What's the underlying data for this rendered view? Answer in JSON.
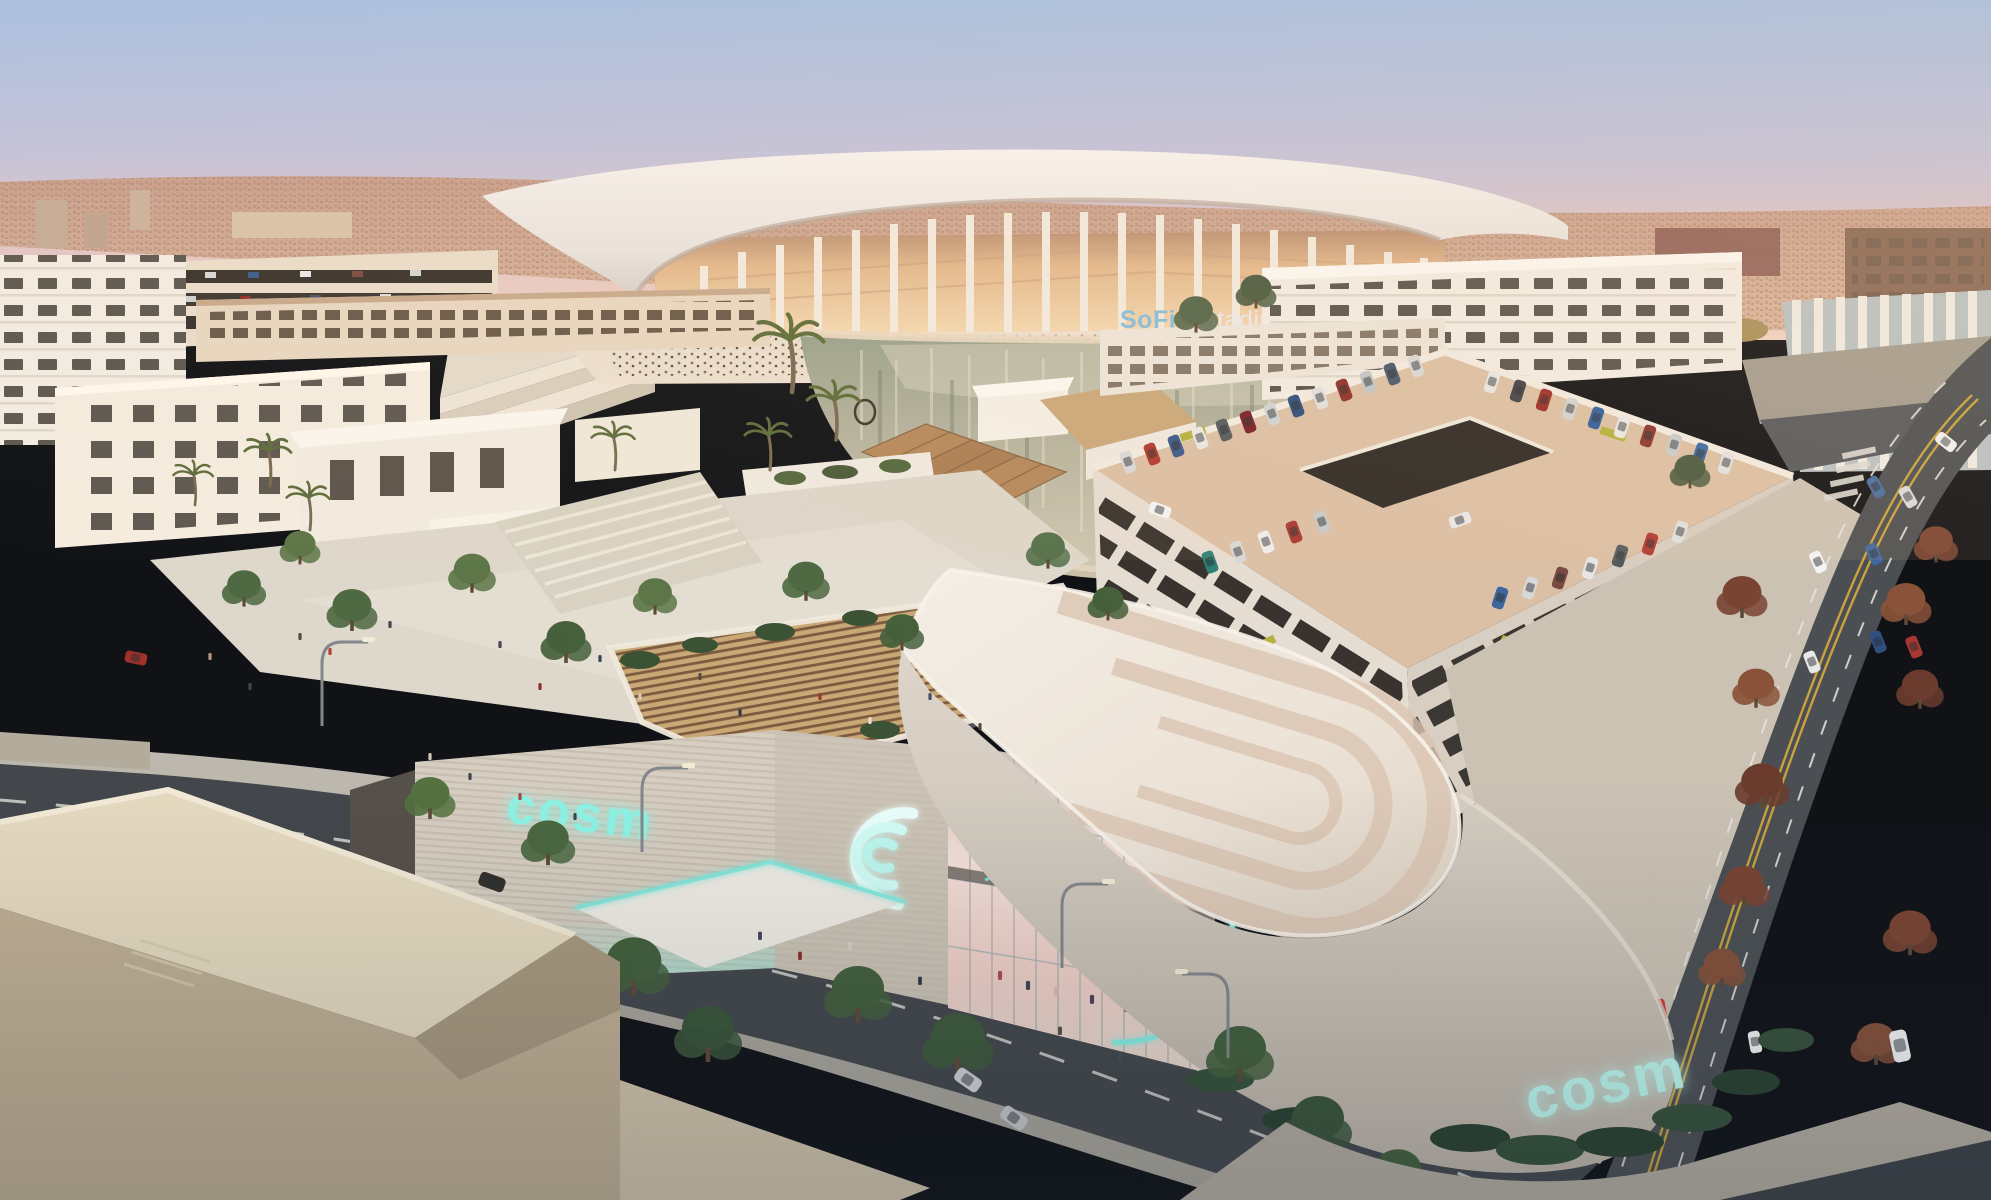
{
  "signs": {
    "stadium": {
      "brand": "SoFi",
      "name": "Stadium"
    },
    "cosm_wall": {
      "text": "cosm"
    },
    "cosm_base": {
      "text": "cosm"
    },
    "cosm_arcs_logo": {
      "icon": "triple-nested-arcs"
    }
  },
  "colors": {
    "sofi_brand_blue": "#85bcdd",
    "stadium_name_white": "#e9e6f1",
    "neon_teal": "#8df3e5",
    "neon_teal_soft": "#bffaf0",
    "sky_top": "#a3bfe6",
    "sunset_pink": "#efcdc2",
    "water_green": "#adb099",
    "asphalt_gray": "#45494d",
    "roof_cream": "#f0e9de",
    "sand_stone": "#d9c7ae"
  }
}
